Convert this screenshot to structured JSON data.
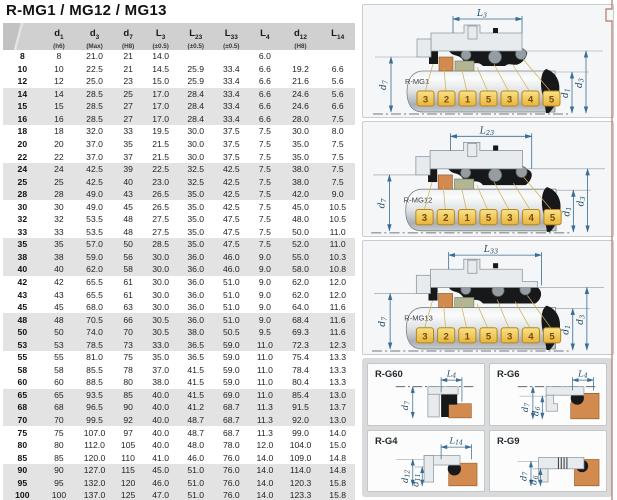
{
  "title": "R-MG1 / MG12 / MG13",
  "table": {
    "columns": [
      {
        "base": "",
        "sub": "",
        "tol": ""
      },
      {
        "base": "d",
        "sub": "1",
        "tol": "(h6)"
      },
      {
        "base": "d",
        "sub": "3",
        "tol": "(Max)"
      },
      {
        "base": "d",
        "sub": "7",
        "tol": "(H8)"
      },
      {
        "base": "L",
        "sub": "3",
        "tol": "(±0.5)"
      },
      {
        "base": "L",
        "sub": "23",
        "tol": "(±0.5)"
      },
      {
        "base": "L",
        "sub": "33",
        "tol": "(±0.5)"
      },
      {
        "base": "L",
        "sub": "4",
        "tol": ""
      },
      {
        "base": "d",
        "sub": "12",
        "tol": "(H8)"
      },
      {
        "base": "L",
        "sub": "14",
        "tol": ""
      }
    ],
    "rows": [
      [
        "8",
        "8",
        "21.0",
        "21",
        "14.0",
        "",
        "",
        "6.0",
        "",
        ""
      ],
      [
        "10",
        "10",
        "22.5",
        "21",
        "14.5",
        "25.9",
        "33.4",
        "6.6",
        "19.2",
        "6.6"
      ],
      [
        "12",
        "12",
        "25.0",
        "23",
        "15.0",
        "25.9",
        "33.4",
        "6.6",
        "21.6",
        "5.6"
      ],
      [
        "14",
        "14",
        "28.5",
        "25",
        "17.0",
        "28.4",
        "33.4",
        "6.6",
        "24.6",
        "5.6"
      ],
      [
        "15",
        "15",
        "28.5",
        "27",
        "17.0",
        "28.4",
        "33.4",
        "6.6",
        "24.6",
        "6.6"
      ],
      [
        "16",
        "16",
        "28.5",
        "27",
        "17.0",
        "28.4",
        "33.4",
        "6.6",
        "28.0",
        "7.5"
      ],
      [
        "18",
        "18",
        "32.0",
        "33",
        "19.5",
        "30.0",
        "37.5",
        "7.5",
        "30.0",
        "8.0"
      ],
      [
        "20",
        "20",
        "37.0",
        "35",
        "21.5",
        "30.0",
        "37.5",
        "7.5",
        "35.0",
        "7.5"
      ],
      [
        "22",
        "22",
        "37.0",
        "37",
        "21.5",
        "30.0",
        "37.5",
        "7.5",
        "35.0",
        "7.5"
      ],
      [
        "24",
        "24",
        "42.5",
        "39",
        "22.5",
        "32.5",
        "42.5",
        "7.5",
        "38.0",
        "7.5"
      ],
      [
        "25",
        "25",
        "42.5",
        "40",
        "23.0",
        "32.5",
        "42.5",
        "7.5",
        "38.0",
        "7.5"
      ],
      [
        "28",
        "28",
        "49.0",
        "43",
        "26.5",
        "35.0",
        "42.5",
        "7.5",
        "42.0",
        "9.0"
      ],
      [
        "30",
        "30",
        "49.0",
        "45",
        "26.5",
        "35.0",
        "42.5",
        "7.5",
        "45.0",
        "10.5"
      ],
      [
        "32",
        "32",
        "53.5",
        "48",
        "27.5",
        "35.0",
        "47.5",
        "7.5",
        "48.0",
        "10.5"
      ],
      [
        "33",
        "33",
        "53.5",
        "48",
        "27.5",
        "35.0",
        "47.5",
        "7.5",
        "50.0",
        "11.0"
      ],
      [
        "35",
        "35",
        "57.0",
        "50",
        "28.5",
        "35.0",
        "47.5",
        "7.5",
        "52.0",
        "11.0"
      ],
      [
        "38",
        "38",
        "59.0",
        "56",
        "30.0",
        "36.0",
        "46.0",
        "9.0",
        "55.0",
        "10.3"
      ],
      [
        "40",
        "40",
        "62.0",
        "58",
        "30.0",
        "36.0",
        "46.0",
        "9.0",
        "58.0",
        "10.8"
      ],
      [
        "42",
        "42",
        "65.5",
        "61",
        "30.0",
        "36.0",
        "51.0",
        "9.0",
        "62.0",
        "12.0"
      ],
      [
        "43",
        "43",
        "65.5",
        "61",
        "30.0",
        "36.0",
        "51.0",
        "9.0",
        "62.0",
        "12.0"
      ],
      [
        "45",
        "45",
        "68.0",
        "63",
        "30.0",
        "36.0",
        "51.0",
        "9.0",
        "64.0",
        "11.6"
      ],
      [
        "48",
        "48",
        "70.5",
        "66",
        "30.5",
        "36.0",
        "51.0",
        "9.0",
        "68.4",
        "11.6"
      ],
      [
        "50",
        "50",
        "74.0",
        "70",
        "30.5",
        "38.0",
        "50.5",
        "9.5",
        "69.3",
        "11.6"
      ],
      [
        "53",
        "53",
        "78.5",
        "73",
        "33.0",
        "36.5",
        "59.0",
        "11.0",
        "72.3",
        "12.3"
      ],
      [
        "55",
        "55",
        "81.0",
        "75",
        "35.0",
        "36.5",
        "59.0",
        "11.0",
        "75.4",
        "13.3"
      ],
      [
        "58",
        "58",
        "85.5",
        "78",
        "37.0",
        "41.5",
        "59.0",
        "11.0",
        "78.4",
        "13.3"
      ],
      [
        "60",
        "60",
        "88.5",
        "80",
        "38.0",
        "41.5",
        "59.0",
        "11.0",
        "80.4",
        "13.3"
      ],
      [
        "65",
        "65",
        "93.5",
        "85",
        "40.0",
        "41.5",
        "69.0",
        "11.0",
        "85.4",
        "13.0"
      ],
      [
        "68",
        "68",
        "96.5",
        "90",
        "40.0",
        "41.2",
        "68.7",
        "11.3",
        "91.5",
        "13.7"
      ],
      [
        "70",
        "70",
        "99.5",
        "92",
        "40.0",
        "48.7",
        "68.7",
        "11.3",
        "92.0",
        "13.0"
      ],
      [
        "75",
        "75",
        "107.0",
        "97",
        "40.0",
        "48.7",
        "68.7",
        "11.3",
        "99.0",
        "14.0"
      ],
      [
        "80",
        "80",
        "112.0",
        "105",
        "40.0",
        "48.0",
        "78.0",
        "12.0",
        "104.0",
        "15.0"
      ],
      [
        "85",
        "85",
        "120.0",
        "110",
        "41.0",
        "46.0",
        "76.0",
        "14.0",
        "109.0",
        "14.8"
      ],
      [
        "90",
        "90",
        "127.0",
        "115",
        "45.0",
        "51.0",
        "76.0",
        "14.0",
        "114.0",
        "14.8"
      ],
      [
        "95",
        "95",
        "132.0",
        "120",
        "46.0",
        "51.0",
        "76.0",
        "14.0",
        "120.3",
        "15.8"
      ],
      [
        "100",
        "100",
        "137.0",
        "125",
        "47.0",
        "51.0",
        "76.0",
        "14.0",
        "123.3",
        "15.8"
      ]
    ]
  },
  "callouts": [
    "3",
    "2",
    "1",
    "5",
    "3",
    "4",
    "5"
  ],
  "dim_labels": {
    "d1": {
      "base": "d",
      "sub": "1"
    },
    "d3": {
      "base": "d",
      "sub": "3"
    },
    "d7": {
      "base": "d",
      "sub": "7"
    }
  },
  "diagrams": [
    {
      "label": "R-MG1",
      "dim": {
        "base": "L",
        "sub": "3"
      }
    },
    {
      "label": "R-MG12",
      "dim": {
        "base": "L",
        "sub": "23"
      }
    },
    {
      "label": "R-MG13",
      "dim": {
        "base": "L",
        "sub": "33"
      }
    }
  ],
  "details": [
    {
      "label": "R-G60",
      "dim": {
        "base": "L",
        "sub": "4"
      },
      "d_outer": {
        "base": "d",
        "sub": "7"
      }
    },
    {
      "label": "R-G6",
      "dim": {
        "base": "L",
        "sub": "4"
      },
      "d_outer": {
        "base": "d",
        "sub": "7"
      },
      "d_inner": {
        "base": "d",
        "sub": "6"
      }
    },
    {
      "label": "R-G4",
      "dim": {
        "base": "L",
        "sub": "14"
      },
      "d_outer": {
        "base": "d",
        "sub": "12"
      },
      "d_inner": {
        "base": "d",
        "sub": "11"
      }
    },
    {
      "label": "R-G9",
      "d_outer": {
        "base": "d",
        "sub": "7"
      },
      "d_inner": {
        "base": "d",
        "sub": "6"
      }
    }
  ],
  "colors": {
    "dim_line": "#3a6e96",
    "callout_fill": "#f2cf5b",
    "callout_border": "#b8861d",
    "orange_part": "#d28a4e",
    "olive_part": "#b2b694",
    "housing": "#e7ebee",
    "header_bg": "#d0d0d0",
    "stripe_bg": "#e3e3e3",
    "page_edge": "#b0766c"
  }
}
